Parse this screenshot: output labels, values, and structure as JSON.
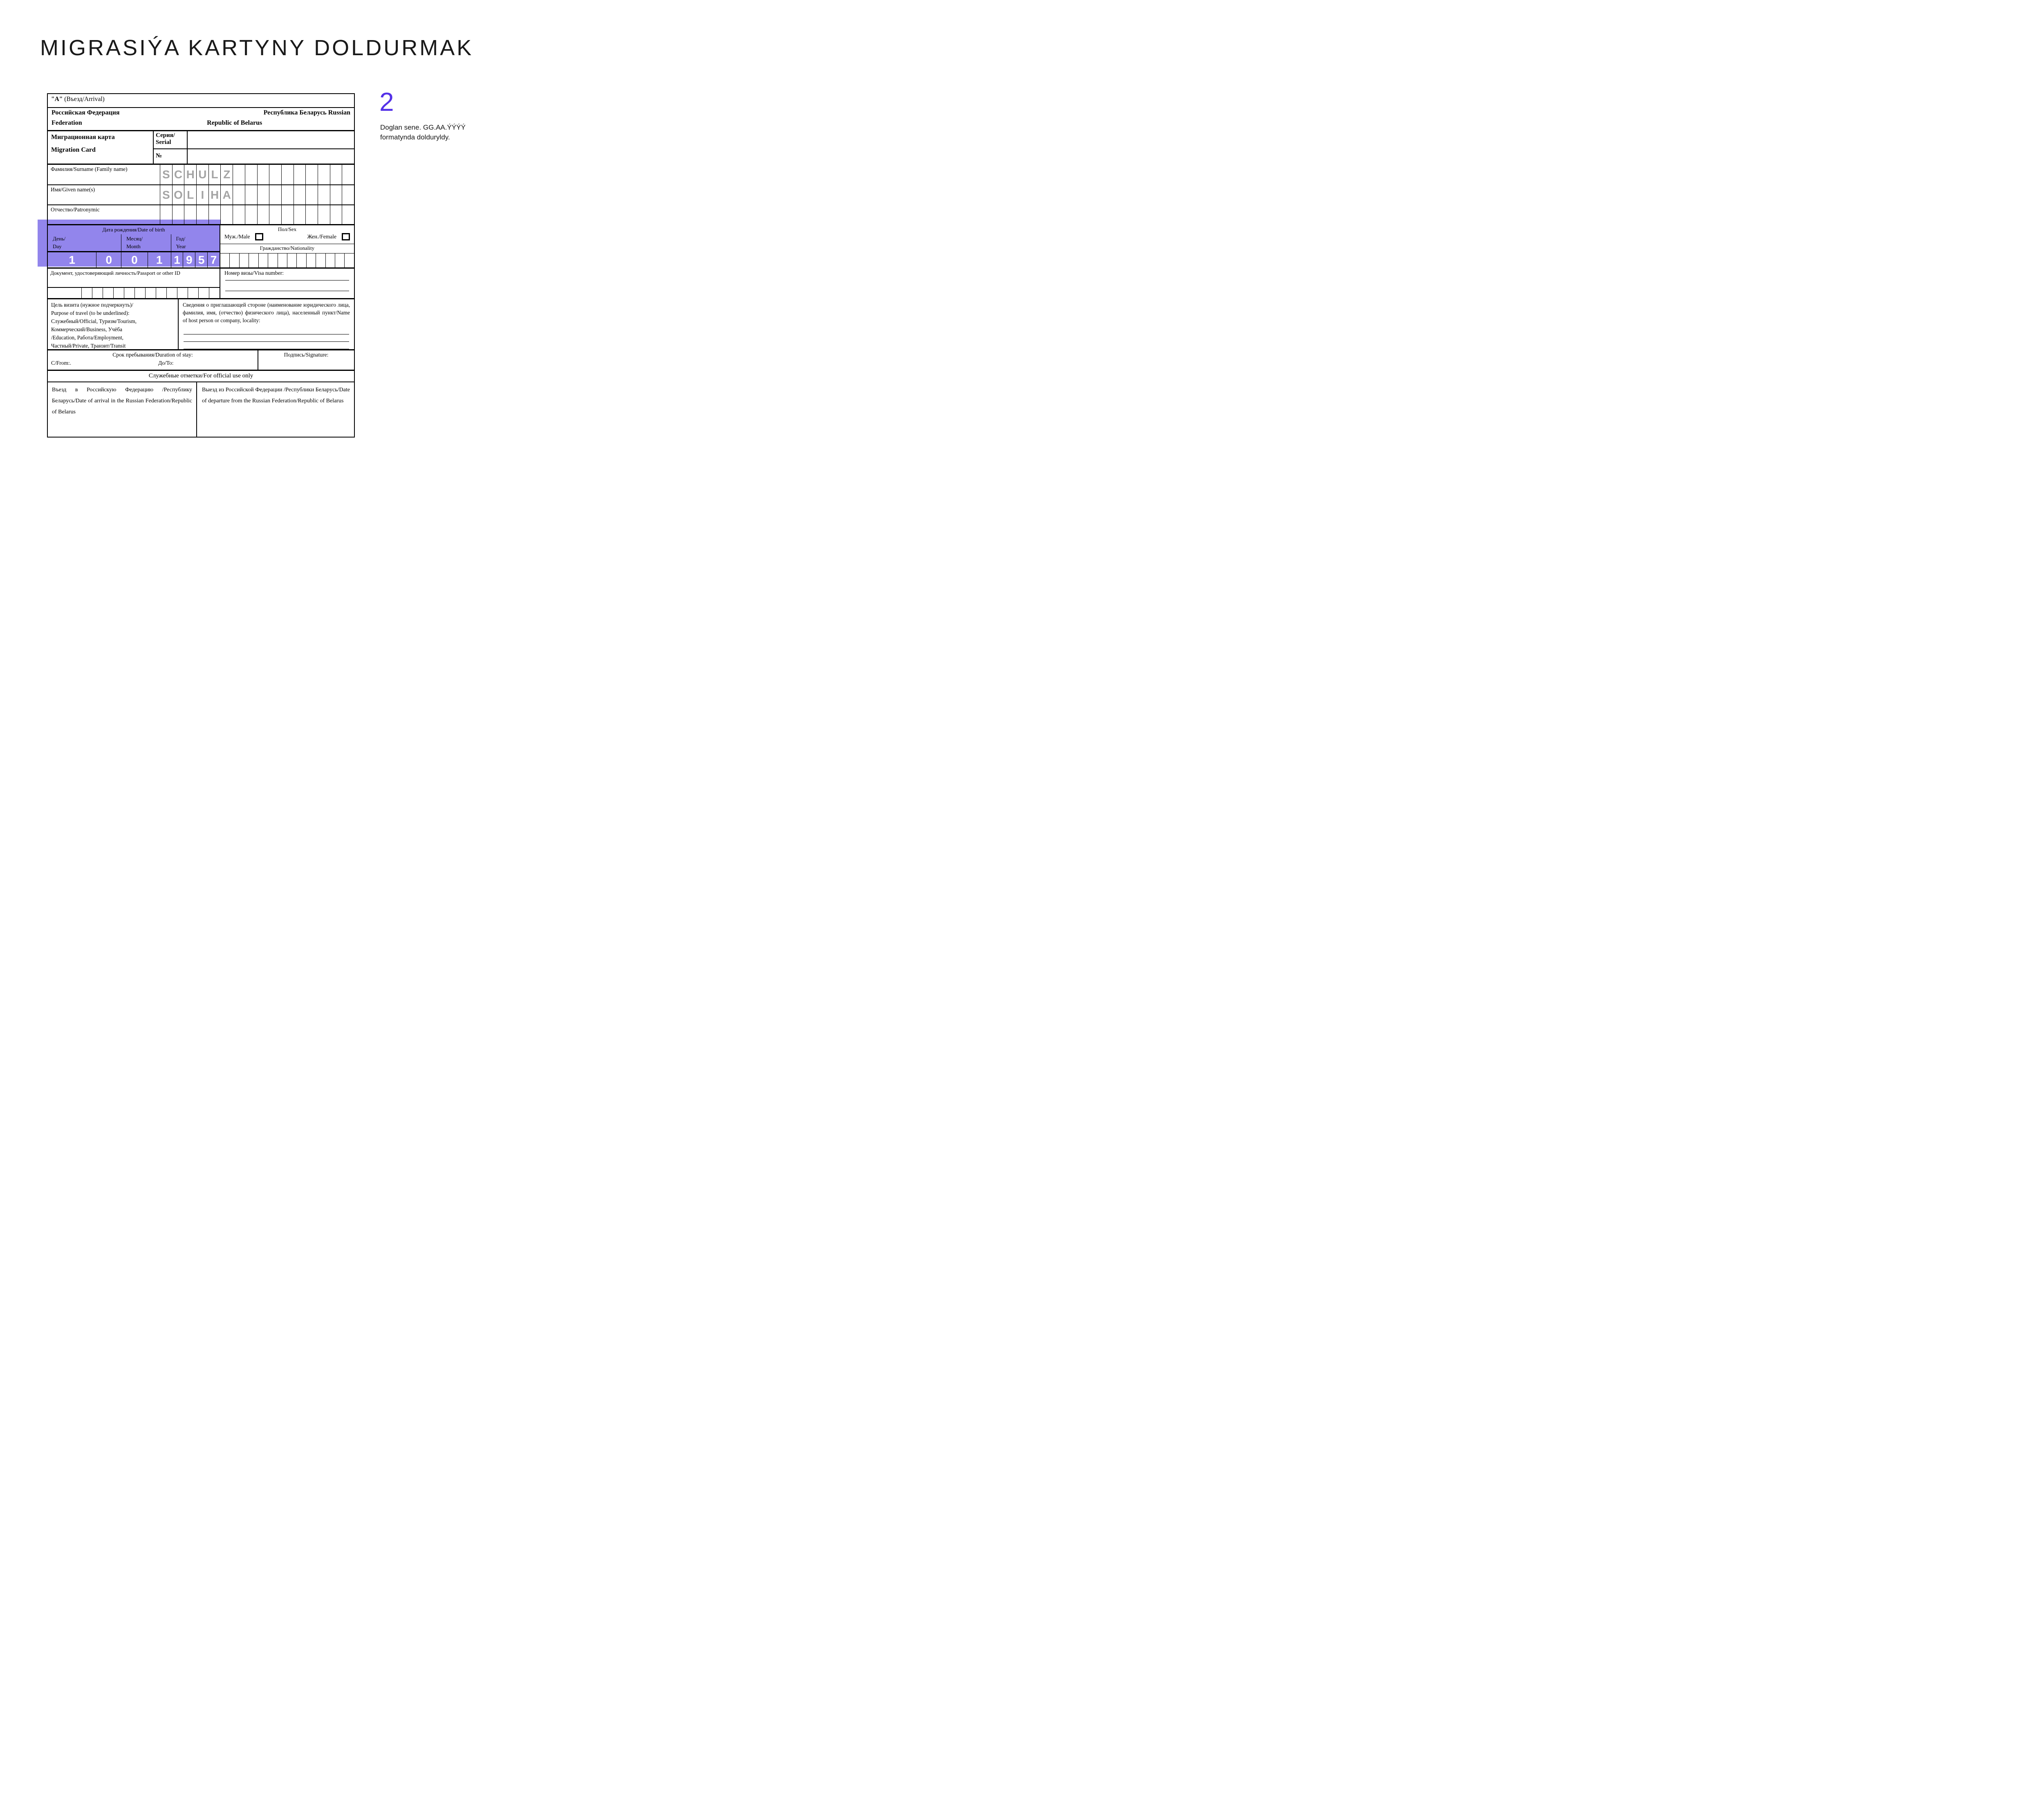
{
  "colors": {
    "highlight_purple": "#9285EC",
    "step_accent_purple": "#5431E8",
    "filled_letters_gray": "#A4A4A4",
    "filled_digits_white": "#FFFFFF"
  },
  "page_title": "MIGRASIÝA KARTYNY DOLDURMAK",
  "step": {
    "number": "2",
    "caption": "Doglan sene. GG.AA.ÝÝÝÝ formatynda dolduryldy."
  },
  "form": {
    "section_a": {
      "prefix": "\"А\"",
      "label": " (Въезд/Arrival)"
    },
    "countries": {
      "ru_left": "Российская Федерация",
      "ru_right": "Республика Беларусь  Russian",
      "en_left": "Federation",
      "en_right": "Republic of Belarus"
    },
    "card": {
      "title_ru": "Миграционная карта",
      "title_en": "Migration Card",
      "serial_ru": "Серия/",
      "serial_en": "Serial",
      "number_sign": "№"
    },
    "surname": {
      "label": "Фамилия/Surname (Family name)",
      "cells": {
        "count": 16,
        "values": [
          "S",
          "C",
          "H",
          "U",
          "L",
          "Z"
        ]
      }
    },
    "given_name": {
      "label": "Имя/Given name(s)",
      "cells": {
        "count": 16,
        "values": [
          "S",
          "O",
          "L",
          "I",
          "H",
          "A"
        ]
      }
    },
    "patronymic": {
      "label": "Отчество/Patronymic",
      "cells": {
        "count": 16,
        "values": []
      }
    },
    "dob": {
      "title": "Дата рождения/Date of birth",
      "day_ru": "День/",
      "day_en": "Day",
      "month_ru": "Месяц/",
      "month_en": "Month",
      "year_ru": "Год/",
      "year_en": "Year",
      "digits": [
        "1",
        "0",
        "0",
        "1",
        "1",
        "9",
        "5",
        "7"
      ]
    },
    "sex": {
      "title": "Пол/Sex",
      "male": "Муж./Male",
      "female": "Жен./Female"
    },
    "nationality": {
      "label": "Гражданство/Nationality",
      "cells": {
        "count": 14,
        "values": []
      }
    },
    "passport": {
      "label": "Документ, удостоверяющий личность/Passport  or other ID",
      "cells": {
        "count": 13,
        "values": []
      }
    },
    "visa": {
      "label": "Номер визы/Visa number:"
    },
    "purpose": {
      "lines": [
        "Цель визита (нужное подчеркнуть)/",
        "Purpose of travel (to be underlined):",
        "Служебный/Official, Туризм/Tourism,",
        "Коммерческий/Business, Учёба",
        "/Education, Работа/Employment,",
        "Частный/Private, Транзит/Transit"
      ]
    },
    "host": {
      "text": "Сведения о приглашающей стороне (наименование юридического лица, фамилия, имя, (отчество) физического лица), населенный пункт/Name of host person or company, locality:"
    },
    "stay": {
      "title": "Срок пребывания/Duration of stay:",
      "from": "С/From:.",
      "to": "До/To:"
    },
    "signature": {
      "label": "Подпись/Signature:"
    },
    "official": {
      "label": "Служебные отметки/For official use only"
    },
    "arrival": {
      "text": "Въезд в Российскую Федерацию /Республику Беларусь/Date of arrival in the Russian Federation/Republic of Belarus"
    },
    "departure": {
      "text": "Выезд из Российской Федерации /Республики Беларусь/Date of departure from the Russian Federation/Republic of Belarus"
    }
  }
}
